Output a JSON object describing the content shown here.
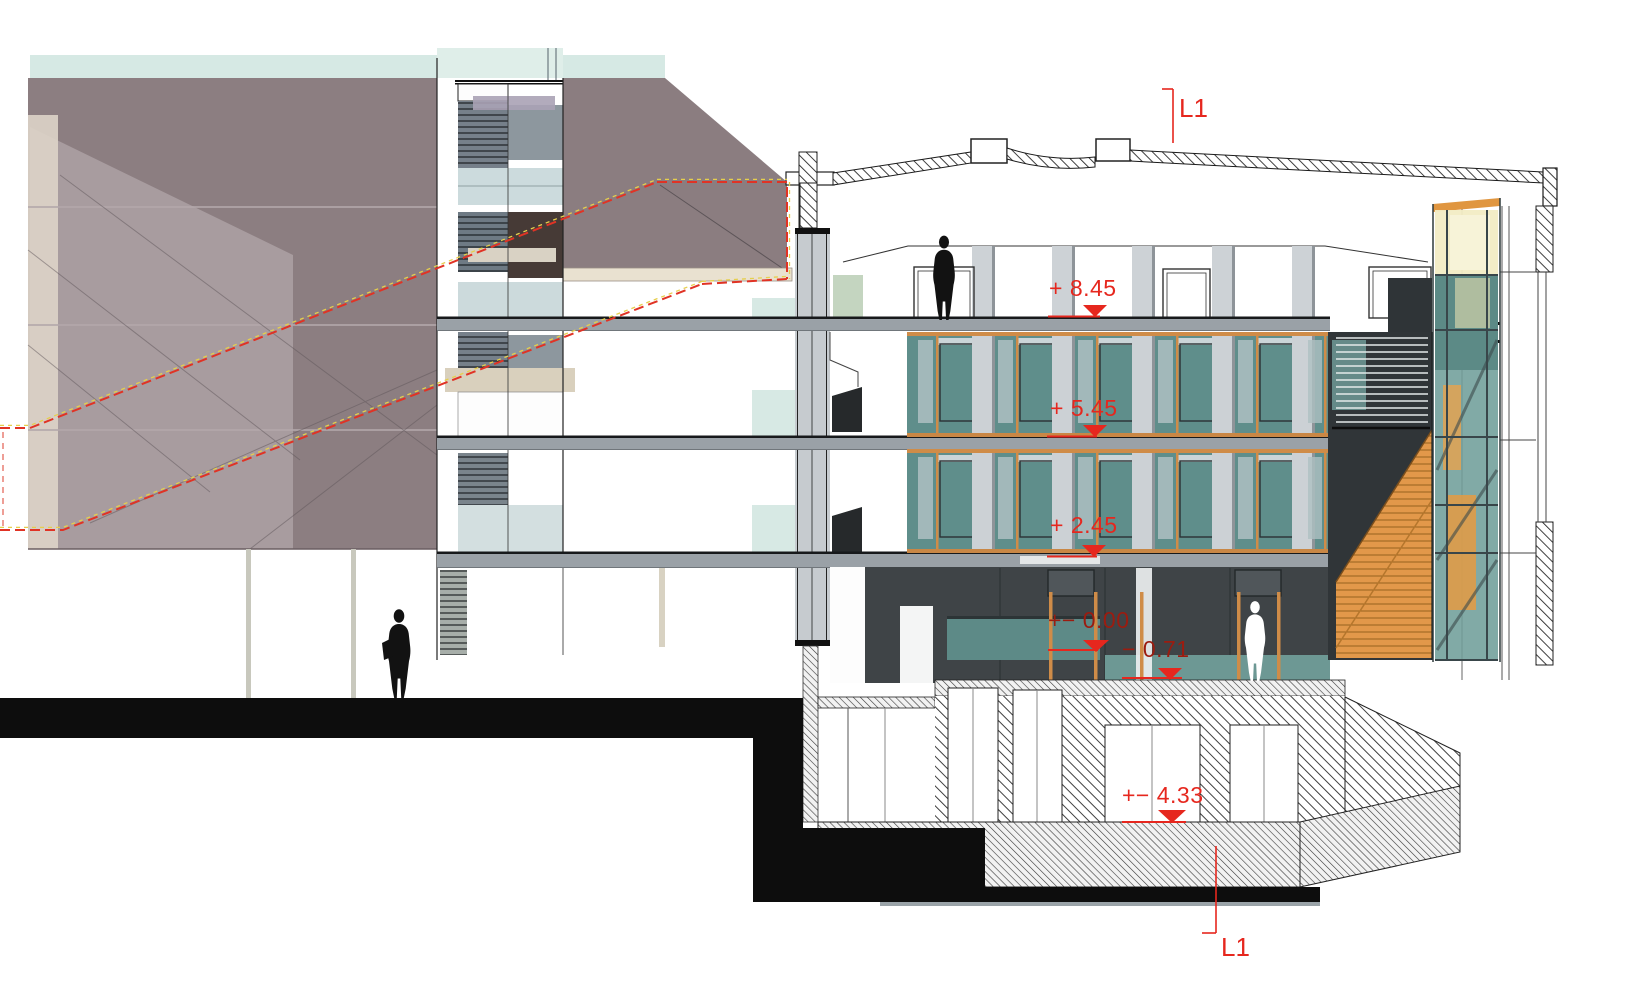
{
  "drawing": {
    "title": "Building cross-section L1–L1",
    "section_marks": {
      "top": "L1",
      "bottom": "L1"
    },
    "levels": [
      {
        "name": "roof-terrace",
        "label": "+ 8.45"
      },
      {
        "name": "second-floor",
        "label": "+ 5.45"
      },
      {
        "name": "first-floor",
        "label": "+ 2.45"
      },
      {
        "name": "ground-floor",
        "label": "+− 0.00"
      },
      {
        "name": "lowered-ground",
        "label": "− 0.71"
      },
      {
        "name": "basement",
        "label": "+− 4.33"
      }
    ],
    "figures": [
      {
        "name": "person-on-roof-terrace",
        "style": "black silhouette"
      },
      {
        "name": "person-on-street",
        "style": "black silhouette with bag"
      },
      {
        "name": "person-ground-floor",
        "style": "white silhouette"
      }
    ],
    "colors": {
      "annotation_red": "#e6271e",
      "annotation_red_dark": "#9b1c10",
      "dashed_overlay_red": "#e03325",
      "dashed_overlay_yellow": "#e6cf4d",
      "facade_mauve": "#8c7e81",
      "facade_mauve_light": "#a89c9f",
      "facade_cream": "#ddd4c8",
      "sky_band_teal": "#d6e9e4",
      "glass_teal": "#5f8e8b",
      "glass_pale": "#ccdbdd",
      "frame_orange": "#cf8c48",
      "stair_orange": "#e2984a",
      "elevator_glass_yellow": "#f2ecc4",
      "slab_gray": "#9aa1a7",
      "interior_dark": "#3f4447",
      "ground_black": "#0d0d0d"
    }
  }
}
